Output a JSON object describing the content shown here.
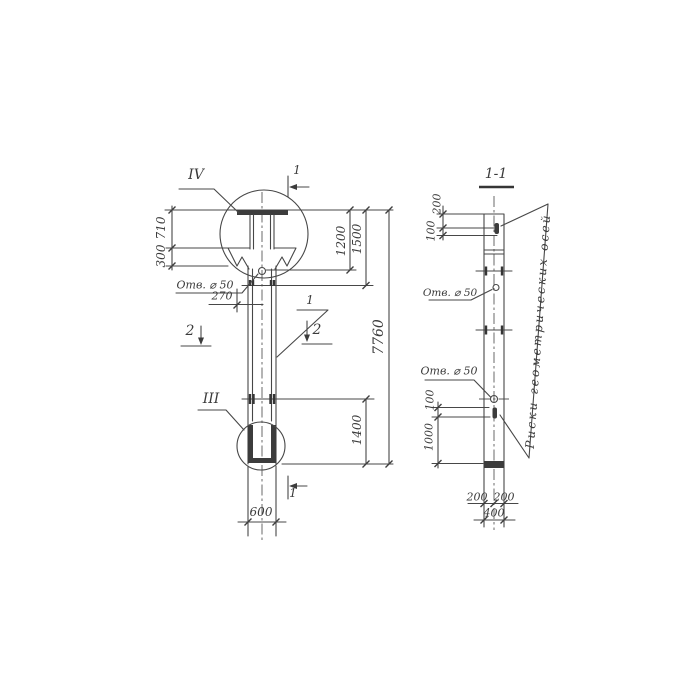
{
  "colors": {
    "ink": "#474747",
    "paper": "#ffffff"
  },
  "section_title": "1-1",
  "left_view": {
    "detail_top": "IV",
    "detail_bottom": "III",
    "pos": "1",
    "cut_top": "1",
    "cut_bottom": "1",
    "cut_left": "2",
    "cut_right": "2",
    "hole": "Отв. ⌀ 50",
    "d710": "710",
    "d300": "300",
    "d270": "270",
    "d1200": "1200",
    "d1500": "1500",
    "d7760": "7760",
    "d1400": "1400",
    "d600": "600"
  },
  "section_view": {
    "hole_top": "Отв. ⌀ 50",
    "hole_bottom": "Отв. ⌀ 50",
    "axes_note": "Риски геометрических осей",
    "d200t": "200",
    "d100t": "100",
    "d100b": "100",
    "d1000": "1000",
    "d200l": "200",
    "d200r": "200",
    "d400": "400"
  }
}
